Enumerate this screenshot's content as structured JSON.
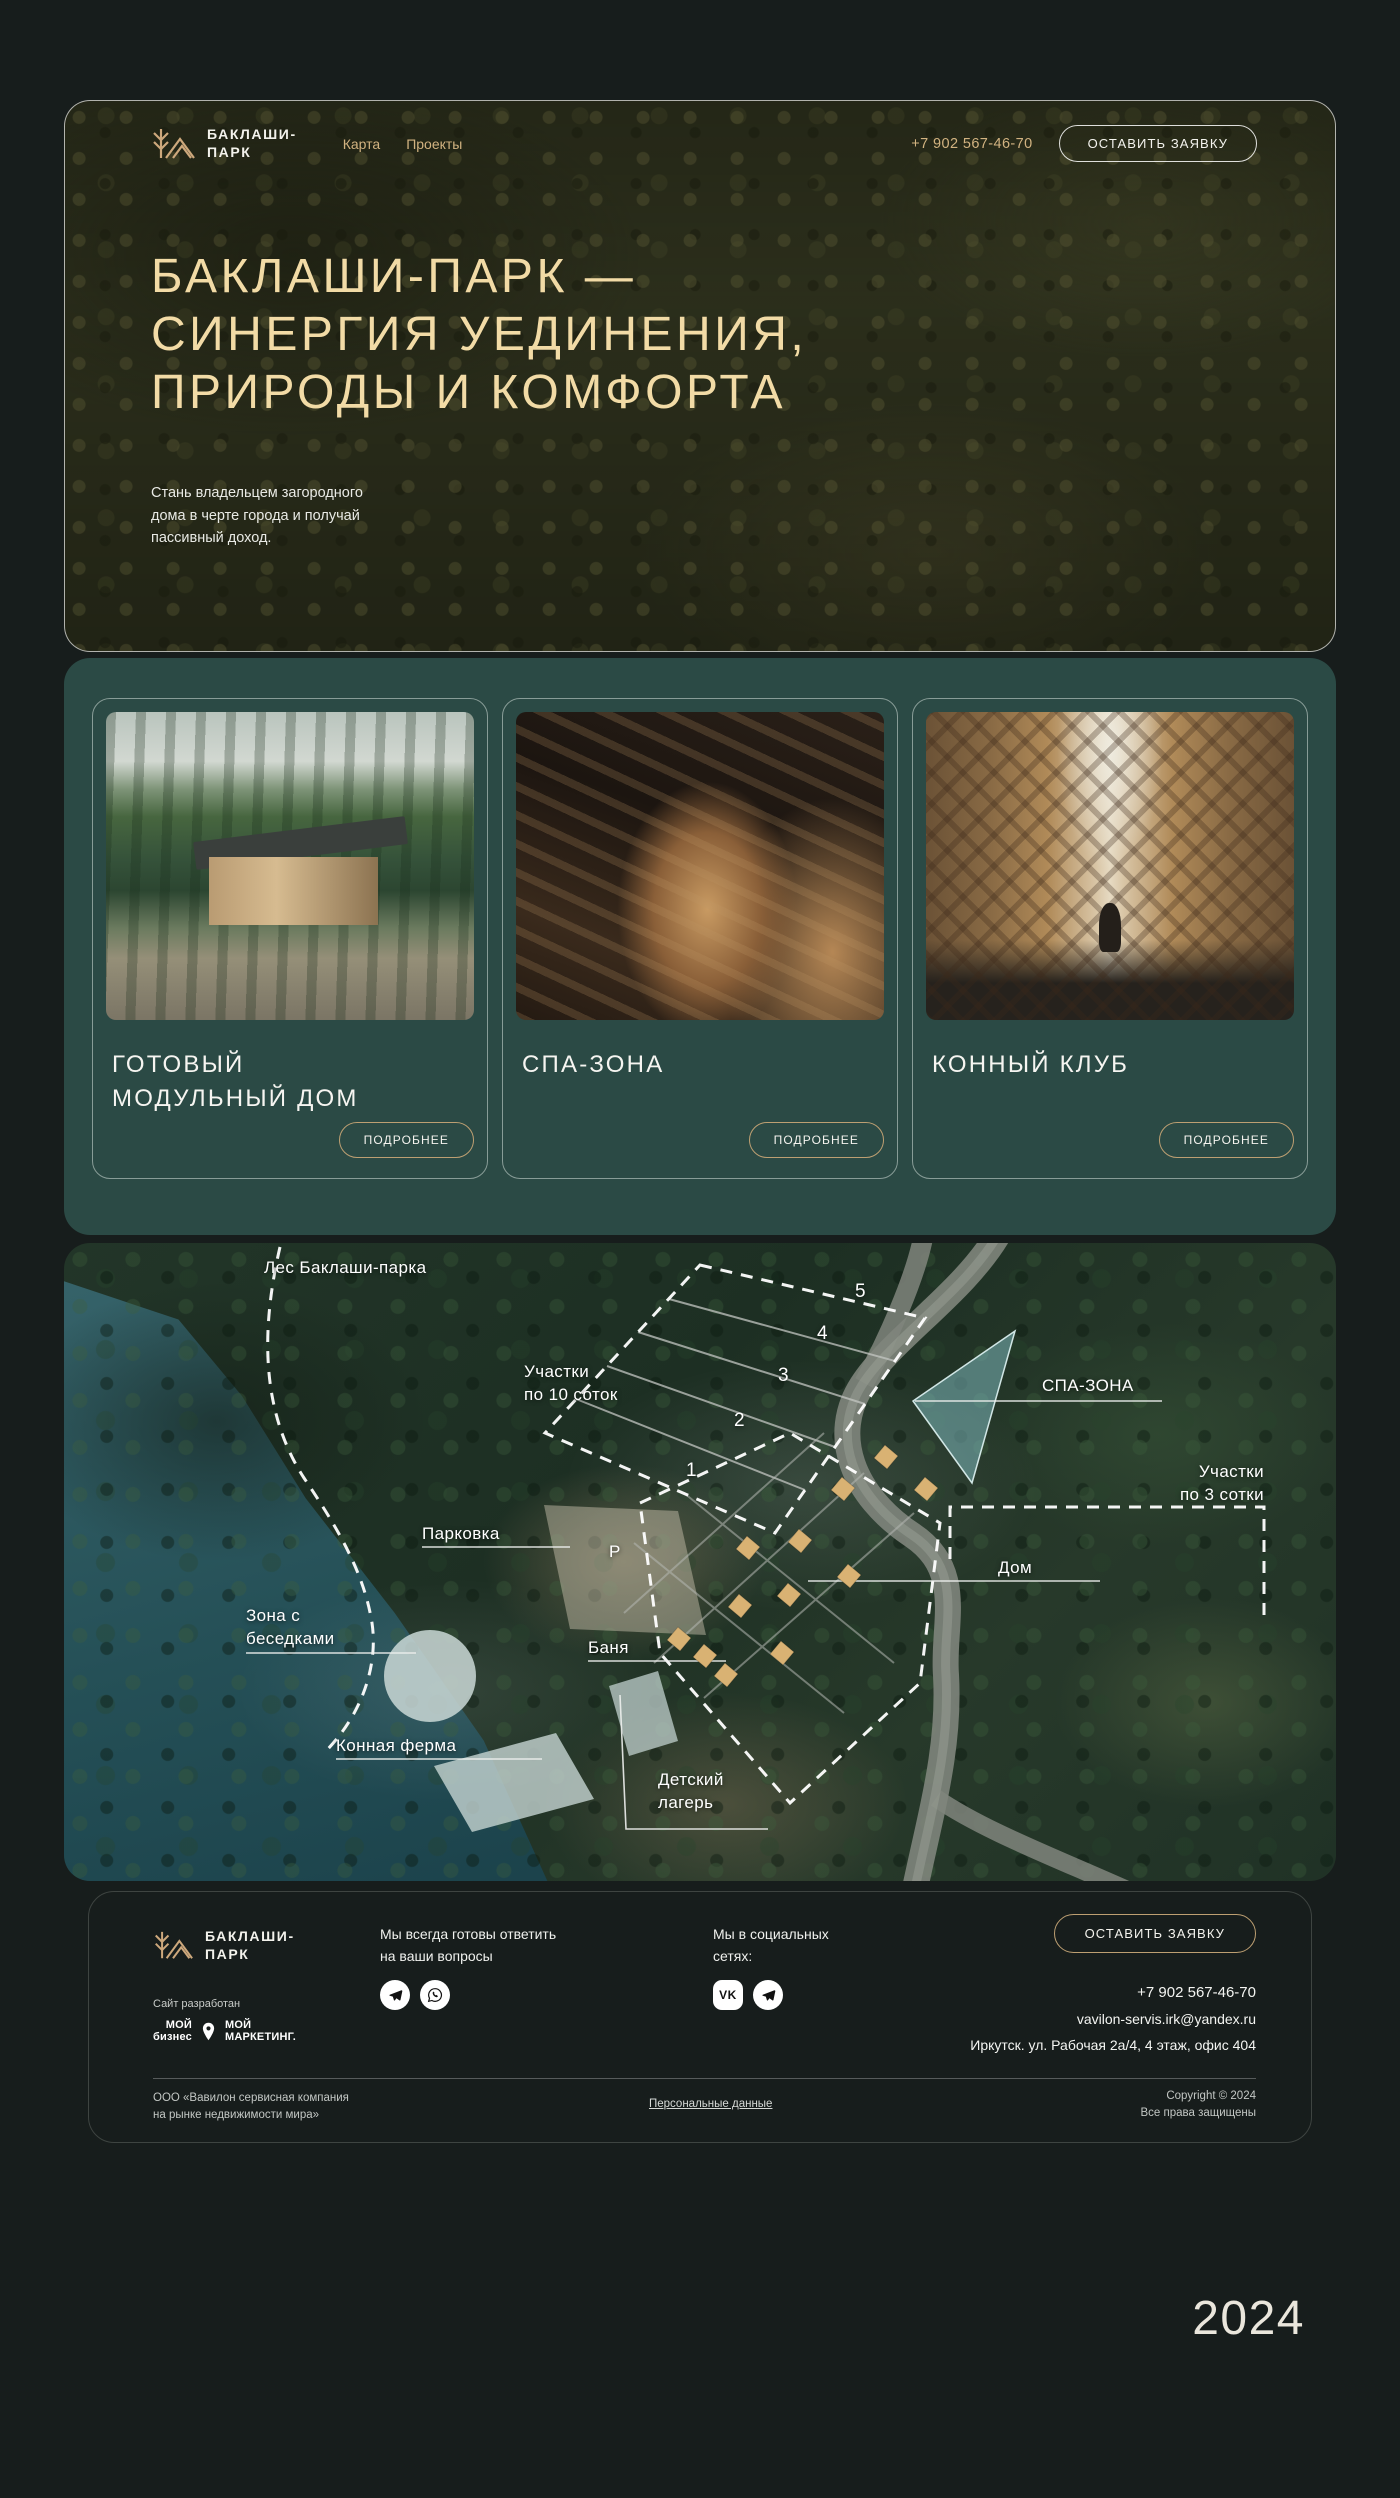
{
  "brand": {
    "name_line1": "БАКЛАШИ-",
    "name_line2": "ПАРК"
  },
  "header": {
    "nav": [
      {
        "label": "Карта"
      },
      {
        "label": "Проекты"
      }
    ],
    "phone": "+7 902 567-46-70",
    "cta": "ОСТАВИТЬ ЗАЯВКУ"
  },
  "hero": {
    "title_line1": "БАКЛАШИ-ПАРК —",
    "title_line2": "СИНЕРГИЯ УЕДИНЕНИЯ,",
    "title_line3": "ПРИРОДЫ И КОМФОРТА",
    "subtitle": "Стань владельцем загородного\nдома в черте города и получай\nпассивный доход."
  },
  "cards": [
    {
      "title": "ГОТОВЫЙ\nМОДУЛЬНЫЙ ДОМ",
      "button": "ПОДРОБНЕЕ",
      "image": "modular-house"
    },
    {
      "title": "СПА-ЗОНА",
      "button": "ПОДРОБНЕЕ",
      "image": "spa-sauna-interior"
    },
    {
      "title": "КОННЫЙ КЛУБ",
      "button": "ПОДРОБНЕЕ",
      "image": "horse-stable"
    }
  ],
  "map": {
    "forest_label": "Лес Баклаши-парка",
    "plots10_label": "Участки\nпо 10 соток",
    "spa_label": "СПА-ЗОНА",
    "plots3_label": "Участки\nпо 3 сотки",
    "parking_label": "Парковка",
    "parking_letter": "Р",
    "gazebo_label": "Зона с\nбеседками",
    "banya_label": "Баня",
    "house_label": "Дом",
    "horse_farm_label": "Конная ферма",
    "camp_label": "Детский\nлагерь",
    "plot_numbers": [
      "1",
      "2",
      "3",
      "4",
      "5"
    ]
  },
  "footer": {
    "questions_text": "Мы всегда готовы ответить\nна ваши вопросы",
    "social_text": "Мы в социальных\nсетях:",
    "vk_text": "VK",
    "cta": "ОСТАВИТЬ ЗАЯВКУ",
    "phone": "+7 902 567-46-70",
    "email": "vavilon-servis.irk@yandex.ru",
    "address": "Иркутск. ул. Рабочая 2а/4, 4 этаж, офис 404",
    "developed_by": "Сайт разработан",
    "dev_logo1_top": "МОЙ",
    "dev_logo1_bottom": "бизнес",
    "dev_logo2_top": "МОЙ",
    "dev_logo2_bottom": "МАРКЕТИНГ.",
    "company": "ООО «Вавилон сервисная компания\nна рынке недвижимости мира»",
    "personal_data_link": "Персональные данные",
    "copyright": "Copyright © 2024\nВсе права защищены"
  },
  "year_badge": "2024",
  "colors": {
    "page_bg": "#171D1C",
    "accent_gold": "#CDA87C",
    "title_cream": "#F2DBA6",
    "teal_section": "#2B4A45",
    "button_border_gold": "#BD9F72"
  }
}
